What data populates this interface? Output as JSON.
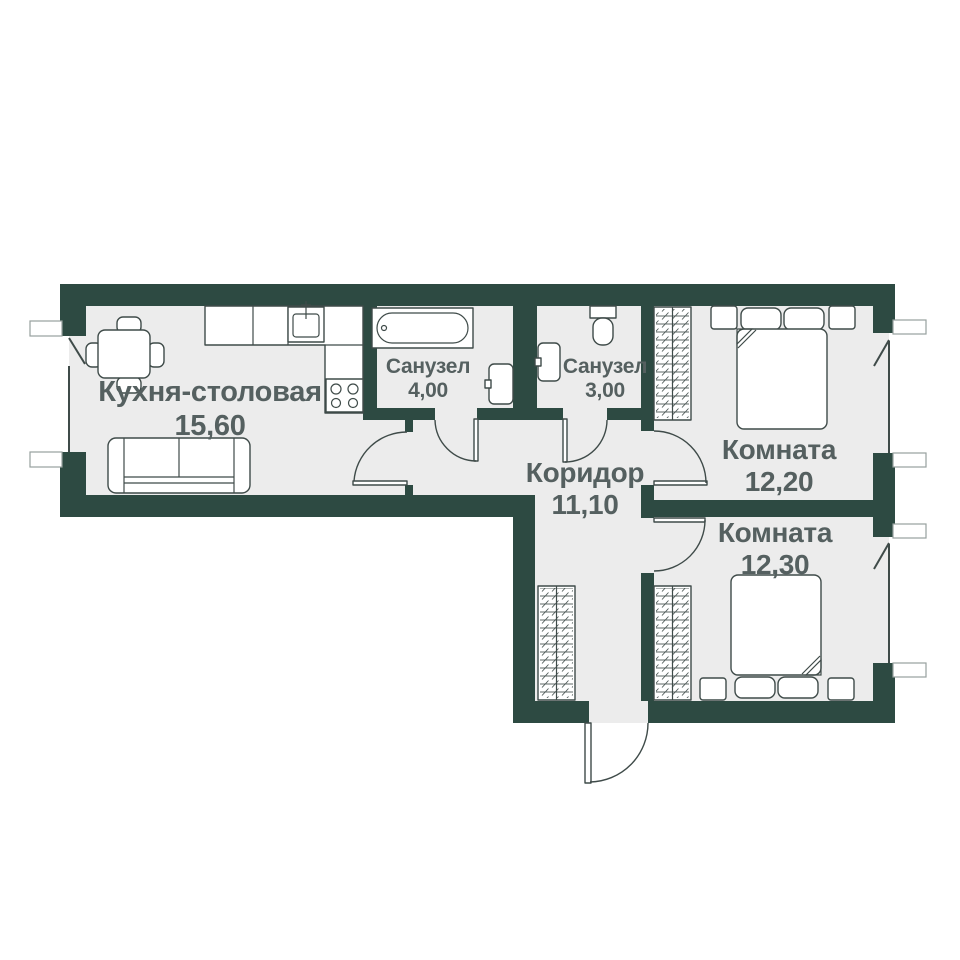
{
  "plan": {
    "type": "apartment-floor-plan",
    "language": "ru",
    "rooms": [
      {
        "name": "Кухня-столовая",
        "area": "15,60"
      },
      {
        "name": "Санузел",
        "area": "4,00"
      },
      {
        "name": "Санузел",
        "area": "3,00"
      },
      {
        "name": "Коридор",
        "area": "11,10"
      },
      {
        "name": "Комната",
        "area": "12,20"
      },
      {
        "name": "Комната",
        "area": "12,30"
      }
    ]
  },
  "colors": {
    "wall": "#2d4a42",
    "floor": "#ececec",
    "line": "#3f4b49",
    "label": "#556060",
    "sill": "#97a09e",
    "bg": "#ffffff"
  },
  "furniture": {
    "kitchen": [
      "dining-table",
      "chairs",
      "kitchen-counter",
      "kitchen-sink",
      "stove",
      "sofa"
    ],
    "bathroom_1": [
      "bathtub",
      "washbasin"
    ],
    "bathroom_2": [
      "toilet",
      "washbasin"
    ],
    "corridor": [
      "wardrobe"
    ],
    "room_1": [
      "double-bed",
      "nightstands",
      "wardrobe"
    ],
    "room_2": [
      "double-bed",
      "nightstands",
      "wardrobe"
    ]
  },
  "openings": {
    "windows": [
      "kitchen-window",
      "room-1-window",
      "room-2-window"
    ],
    "doors": [
      "kitchen-door",
      "bathroom-1-door",
      "bathroom-2-door",
      "room-1-door",
      "room-2-door",
      "entrance-door"
    ]
  }
}
